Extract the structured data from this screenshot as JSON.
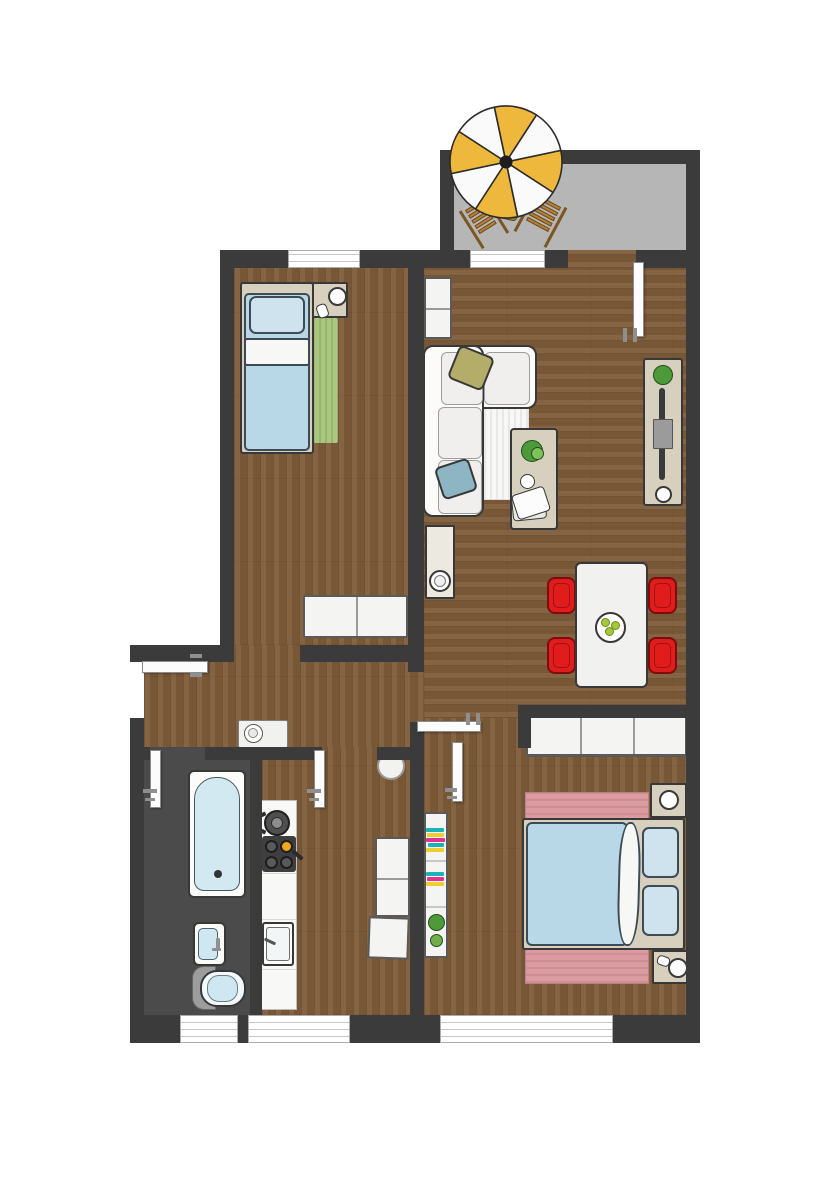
{
  "title": "Apartment floor plan (top-down watercolor style)",
  "palette": {
    "wall": "#3b3b3b",
    "wood": "#7e5c39",
    "bath_floor": "#4b4b4b",
    "balcony_floor": "#b6b6b6",
    "furniture_beige": "#d8d0be",
    "bed_blue": "#b9d8e7",
    "pillow_blue": "#cfe3ee",
    "rug_green": "#a9c87d",
    "rug_pink": "#dc9aa1",
    "chair_red": "#e11c1c",
    "umbrella_yellow": "#eeb83d",
    "wood_chair": "#b28038",
    "burner_yellow": "#f2a81d",
    "plant_green": "#4e9a3a",
    "accent_teal": "#1cb3b8",
    "accent_yellow": "#f0cd30",
    "accent_magenta": "#e03390",
    "apple_green": "#a5c83b"
  },
  "rooms": [
    {
      "name": "Balcony",
      "items": [
        "yellow-white parasol",
        "two wooden deck chairs",
        "small side table"
      ]
    },
    {
      "name": "Bedroom 1",
      "items": [
        "single bed",
        "nightstand with lamp",
        "green striped rug",
        "white cabinet"
      ]
    },
    {
      "name": "Living and dining room",
      "items": [
        "white corner sofa",
        "olive cushion",
        "blue cushion",
        "white rug",
        "coffee table with plant and magazine",
        "wall cabinet",
        "console with bowl",
        "tv lowboard with plant and flat tv",
        "dining table with fruit plate",
        "four red chairs"
      ]
    },
    {
      "name": "Bedroom 2",
      "items": [
        "double bed",
        "two nightstands with lamps",
        "pink rug",
        "three-door sideboard",
        "bookshelf with books and plants"
      ]
    },
    {
      "name": "Kitchen",
      "items": [
        "counter with pot, cooktop and sink",
        "tall cabinet",
        "lower cabinet",
        "round stool"
      ]
    },
    {
      "name": "Bathroom",
      "items": [
        "bathtub",
        "washbasin",
        "toilet"
      ]
    },
    {
      "name": "Hallway",
      "items": [
        "entrance door",
        "console with bowl"
      ]
    }
  ]
}
